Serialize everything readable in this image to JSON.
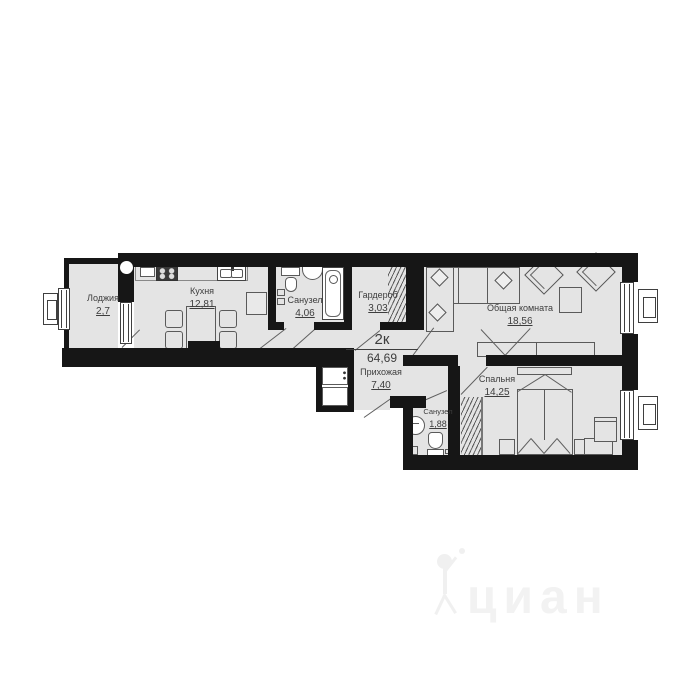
{
  "title": {
    "type": "2к",
    "area": "64,69"
  },
  "rooms": [
    {
      "id": "loggia",
      "name": "Лоджия",
      "area": "2,7"
    },
    {
      "id": "kitchen",
      "name": "Кухня",
      "area": "12,81"
    },
    {
      "id": "bathroom-main",
      "name": "Санузел",
      "area": "4,06"
    },
    {
      "id": "wardrobe",
      "name": "Гардероб",
      "area": "3,03"
    },
    {
      "id": "living-room",
      "name": "Общая комната",
      "area": "18,56"
    },
    {
      "id": "hallway",
      "name": "Прихожая",
      "area": "7,40"
    },
    {
      "id": "bathroom-small",
      "name": "Санузел",
      "area": "1,88"
    },
    {
      "id": "bedroom",
      "name": "Спальня",
      "area": "14,25"
    }
  ],
  "watermark": {
    "text": "циан"
  },
  "colors": {
    "wall": "#161616",
    "floor": "#e4e4e4",
    "furniture_line": "#5a5a5a",
    "text": "#3d3d3d",
    "watermark": "#f2f2f2"
  }
}
